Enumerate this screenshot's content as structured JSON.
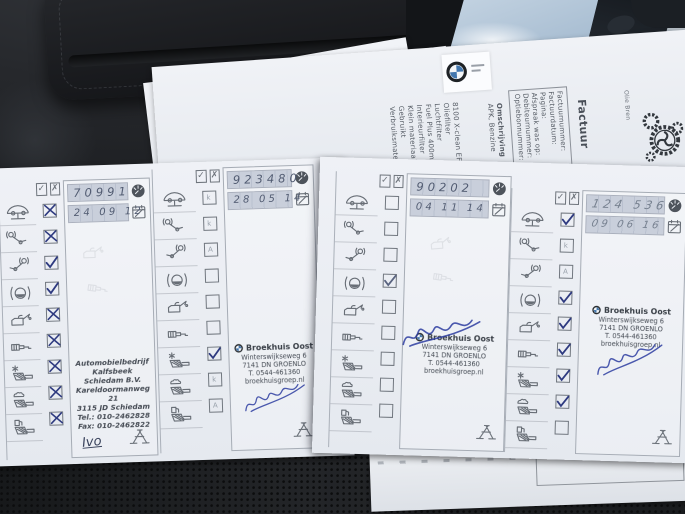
{
  "photo": {
    "setting": "service booklet and invoices on black car seat",
    "colors": {
      "seat": "#1f2124",
      "paper": "#eef0f5",
      "print_grey": "#6b7077",
      "ink_blue": "#2d3da0",
      "pencil": "#525c72",
      "field_grey": "#c6ccd8",
      "sky_blue": "#9cb4cb"
    }
  },
  "invoice": {
    "title": "Factuur",
    "field_labels": [
      "Factuurnummer:",
      "Factuurdatum:",
      "Pagina:",
      "Afspraak was op:",
      "Debiteurnummer:",
      "Optiebonnummer:"
    ],
    "description_header": "Omschrijving",
    "description_value": "APK, Benzine",
    "line_items": [
      "8100 X-clean EFE 5w30",
      "Oliefilter",
      "Luchtfilter",
      "Fuel Plus 400ml",
      "Interieurfilter",
      "Klein materiaal Gebruikt",
      "Verbruiksmateriaal"
    ],
    "side_note": "Olie Bren",
    "thanks_note": "Bedankt voor uw ver",
    "vat_header": "Btw-code",
    "vat_value": "21.0",
    "page_marker": "1",
    "logos": [
      "bmw-roundel",
      "gear-badge"
    ]
  },
  "booklet": {
    "legend": {
      "check": "✓",
      "cross": "✗"
    },
    "box_letters": {
      "letter-k": "k",
      "letter-a": "A"
    },
    "row_icons": [
      "car-on-lift-icon",
      "front-brake-icon",
      "rear-brake-icon",
      "brake-fluid-icon",
      "engine-oil-icon",
      "spark-plug-icon",
      "cabin-filter-icon",
      "air-filter-icon",
      "fuel-filter-icon"
    ],
    "columns": [
      {
        "mileage": "70991",
        "date": "24 09 12",
        "marks": [
          "x",
          "x",
          "check",
          "check",
          "x",
          "x",
          "x",
          "x",
          "x"
        ],
        "stamp": {
          "type": "garage",
          "lines": [
            "Automobielbedrijf",
            "Kalfsbeek Schiedam B.V.",
            "Kareldoormanweg 21",
            "3115 JD Schiedam",
            "Tel.: 010-2462828",
            "Fax: 010-2462822"
          ]
        },
        "signature": "Ivo",
        "signed": true
      },
      {
        "mileage": "923480",
        "date": "28 05 14",
        "marks": [
          "letter-k",
          "letter-k",
          "letter-a",
          "none",
          "none",
          "none",
          "check",
          "letter-k",
          "letter-a"
        ],
        "stamp": {
          "type": "bmw-dealer",
          "name": "Broekhuis Oost",
          "lines": [
            "Winterswijkseweg 6",
            "7141 DN GROENLO",
            "T. 0544-461360",
            "broekhuisgroep.nl"
          ]
        },
        "signature": "",
        "signed": true
      },
      {
        "mileage": "90202",
        "date": "04 11 14",
        "marks": [
          "none",
          "none",
          "none",
          "check",
          "none",
          "none",
          "none",
          "none",
          "none"
        ],
        "stamp": {
          "type": "bmw-dealer",
          "name": "Broekhuis Oost",
          "lines": [
            "Winterswijkseweg 6",
            "7141 DN GROENLO",
            "T. 0544-461360",
            "broekhuisgroep.nl"
          ]
        },
        "signature": "",
        "signed": true
      },
      {
        "mileage": "124 536",
        "date": "09 06 16",
        "marks": [
          "check",
          "letter-k",
          "letter-a",
          "check",
          "check",
          "check",
          "check",
          "check",
          "none"
        ],
        "stamp": {
          "type": "bmw-dealer",
          "name": "Broekhuis Oost",
          "lines": [
            "Winterswijkseweg 6",
            "7141 DN GROENLO",
            "T. 0544-461360",
            "broekhuisgroep.nl"
          ]
        },
        "signature": "",
        "signed": true
      }
    ]
  }
}
